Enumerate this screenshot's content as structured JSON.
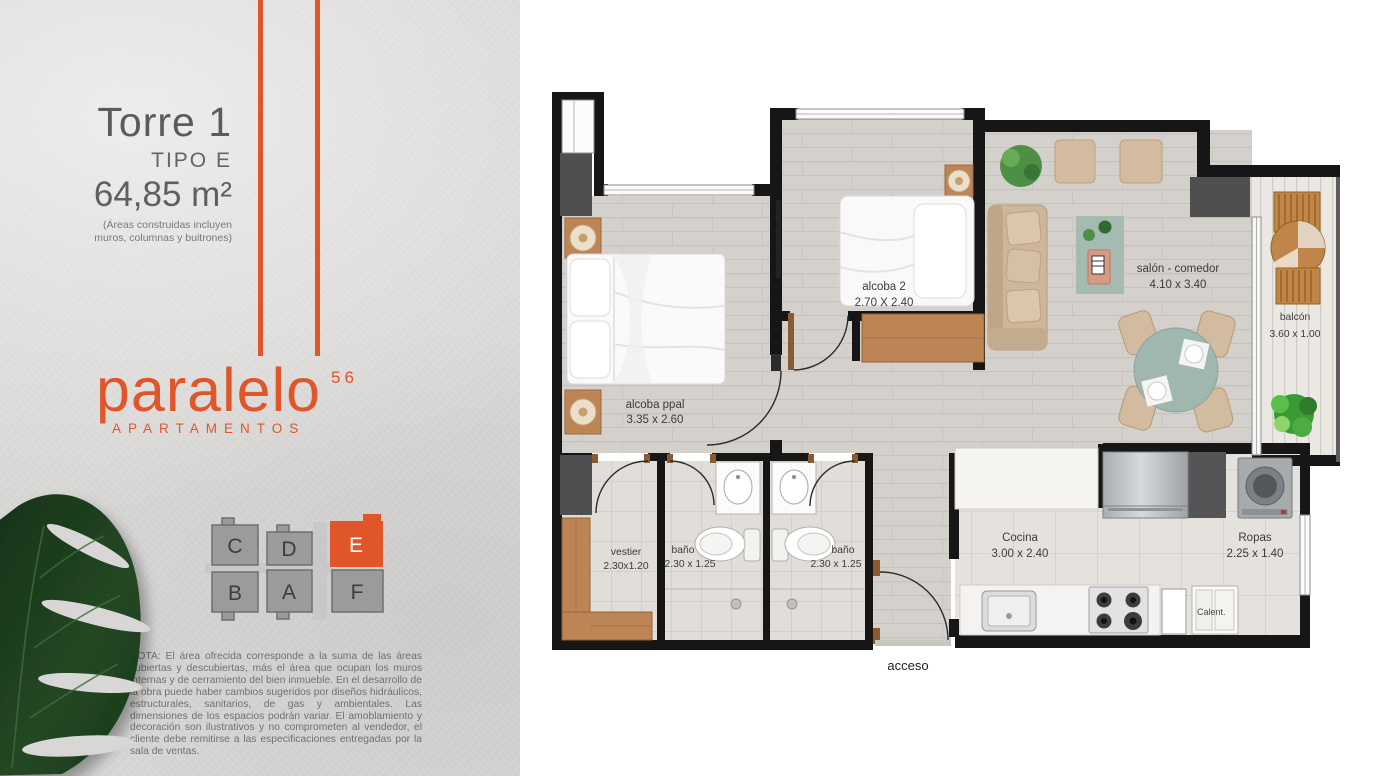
{
  "panel": {
    "tower": "Torre 1",
    "tipo": "TIPO E",
    "area": "64,85 m²",
    "area_note_1": "(Áreas construidas incluyen",
    "area_note_2": "muros, columnas y buitrones)",
    "brand": {
      "name": "paralelo",
      "number": "56",
      "subtitle": "APARTAMENTOS"
    },
    "key_units": {
      "c": "C",
      "d": "D",
      "e": "E",
      "b": "B",
      "a": "A",
      "f": "F"
    },
    "nota": "NOTA: El área ofrecida corresponde a la suma de las áreas cubiertas y descubiertas, más el área que ocupan los muros internas y de cerramiento del bien inmueble. En el desarrollo de la obra puede haber cambios sugeridos por diseños hidráulicos, estructurales, sanitarios, de gas y ambientales. Las dimensiones de los espacios podrán variar. El amoblamiento y decoración son ilustrativos y no comprometen al vendedor, el cliente debe remitirse a las especificaciones entregadas por la sala de ventas."
  },
  "plan": {
    "rooms": {
      "alcoba_ppal": {
        "name": "alcoba ppal",
        "dims": "3.35 x 2.60"
      },
      "alcoba_2": {
        "name": "alcoba 2",
        "dims": "2.70 X 2.40"
      },
      "salon": {
        "name": "salón - comedor",
        "dims": "4.10 x 3.40"
      },
      "balcon": {
        "name": "balcón",
        "dims": "3.60 x 1.00"
      },
      "vestier": {
        "name": "vestier",
        "dims": "2.30x1.20"
      },
      "bano_1": {
        "name": "baño",
        "dims": "2.30 x 1.25"
      },
      "bano_2": {
        "name": "baño",
        "dims": "2.30 x 1.25"
      },
      "cocina": {
        "name": "Cocina",
        "dims": "3.00 x 2.40"
      },
      "ropas": {
        "name": "Ropas",
        "dims": "2.25 x 1.40"
      }
    },
    "entrance_label": "acceso",
    "heater_label": "Calent."
  },
  "colors": {
    "accent": "#e0562a",
    "wall": "#161616",
    "column": "#4f4f4f",
    "wood_floor": "#d4d0cc",
    "tile_floor": "#e4e1dc",
    "furniture_wood": "#bd8456",
    "sofa_beige": "#cdb69a",
    "rug_teal": "#a5bab1",
    "leaf_green": "#21401f"
  }
}
